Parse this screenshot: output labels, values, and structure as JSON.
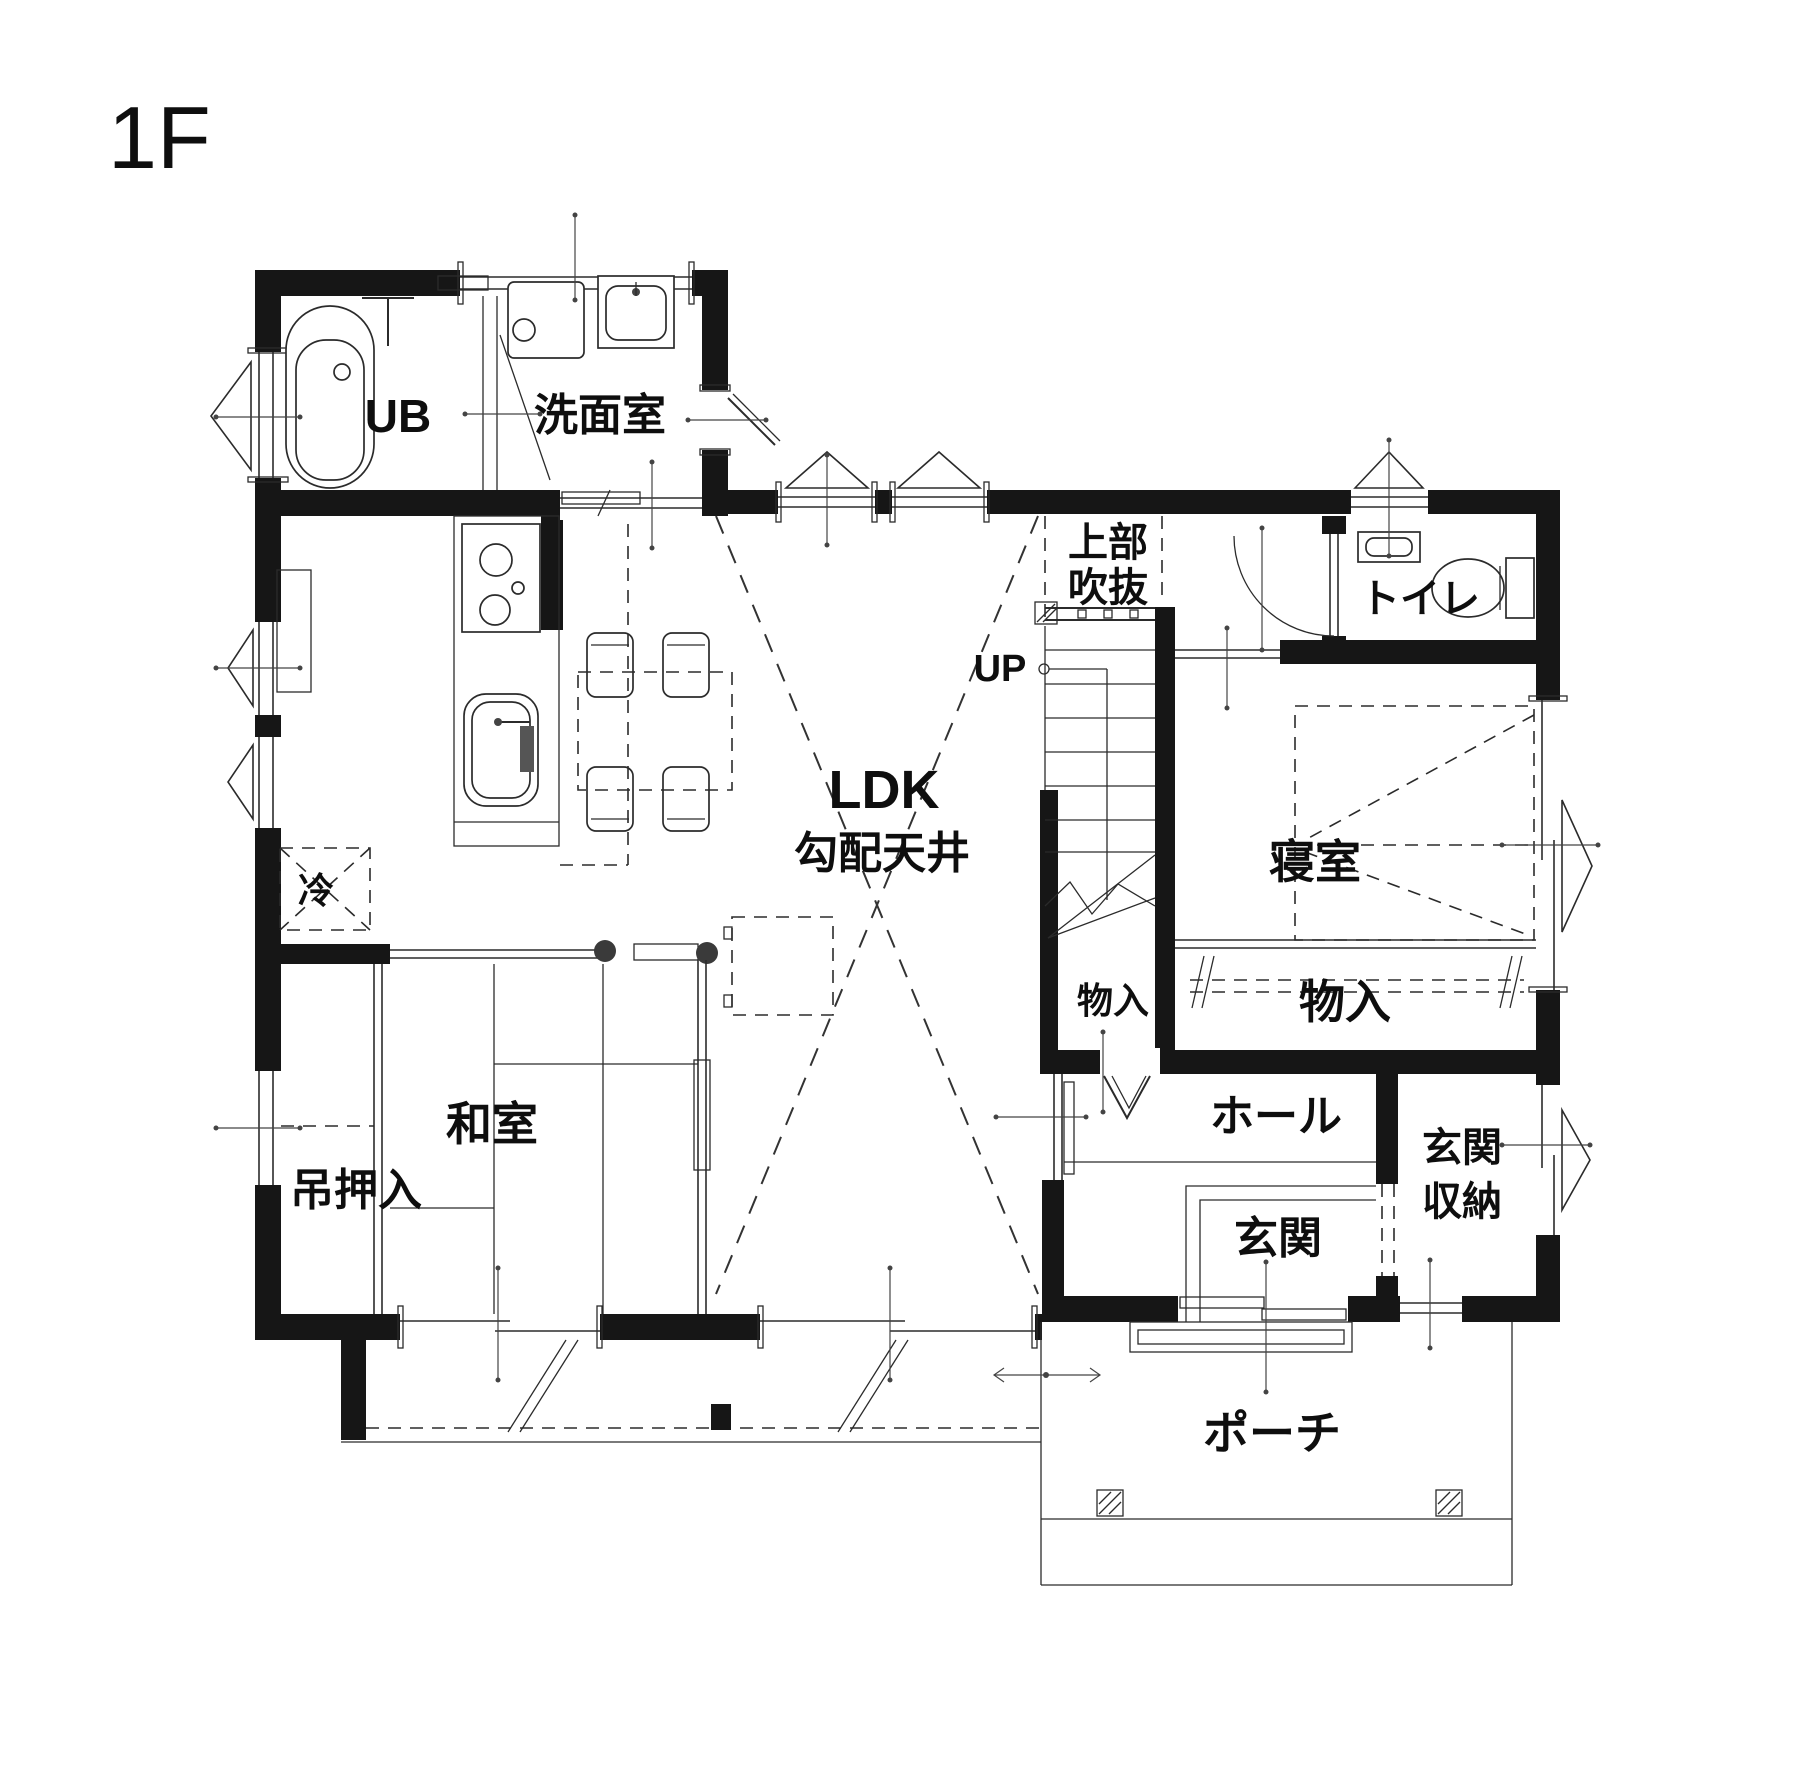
{
  "title": "1F",
  "colors": {
    "wall": "#161616",
    "line": "#2b2b2b",
    "background": "#ffffff",
    "text": "#0e0e0e"
  },
  "labels": {
    "floor": "1F",
    "ub": "UB",
    "washroom": "洗面室",
    "void1": "上部",
    "void2": "吹抜",
    "toilet": "トイレ",
    "up": "UP",
    "ldk": "LDK",
    "ldk_ceiling": "勾配天井",
    "bedroom": "寝室",
    "fridge": "冷",
    "storage_small": "物入",
    "storage_large": "物入",
    "japanese_room": "和室",
    "hanging_closet": "吊押入",
    "hall": "ホール",
    "entrance": "玄関",
    "entrance_storage1": "玄関",
    "entrance_storage2": "収納",
    "porch": "ポーチ"
  }
}
